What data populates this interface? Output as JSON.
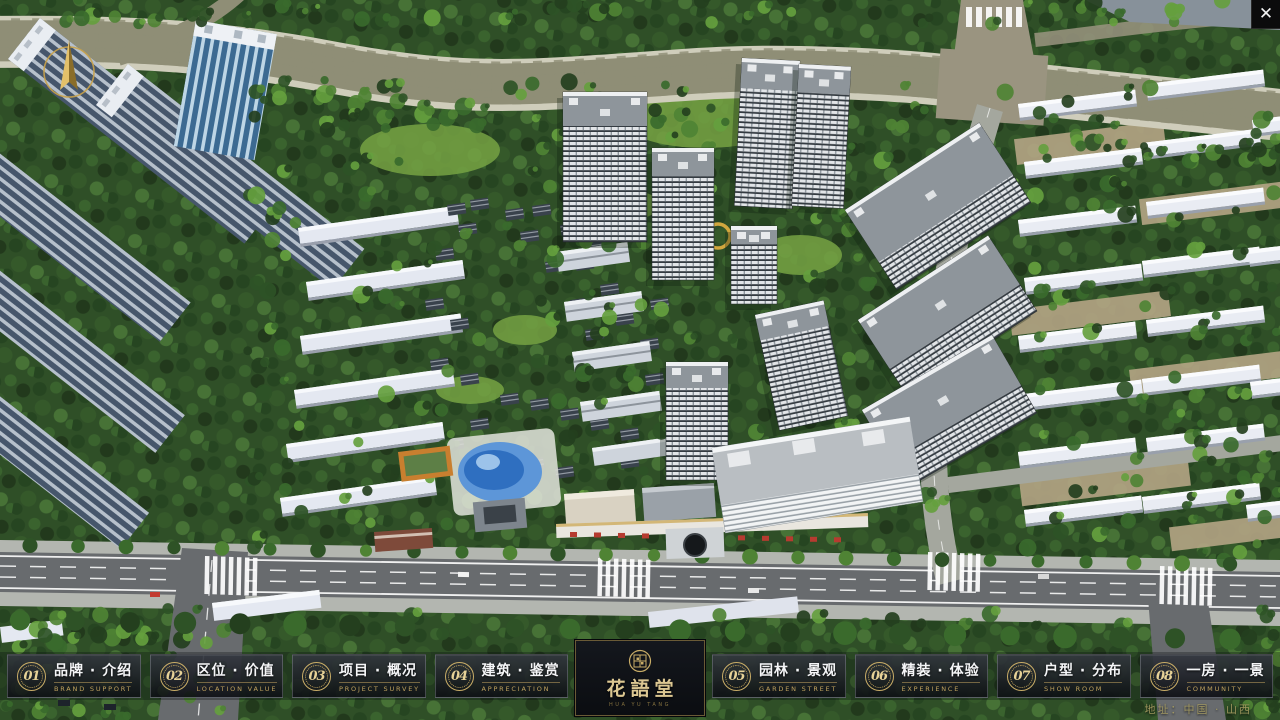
{
  "window": {
    "close_icon": "✕"
  },
  "project": {
    "name_zh": "花語堂",
    "name_en": "HUA YU TANG"
  },
  "nav": {
    "items": [
      {
        "number": "01",
        "label_zh": "品牌 · 介绍",
        "label_en": "BRAND SUPPORT"
      },
      {
        "number": "02",
        "label_zh": "区位 · 价值",
        "label_en": "LOCATION VALUE"
      },
      {
        "number": "03",
        "label_zh": "项目 · 概况",
        "label_en": "PROJECT SURVEY"
      },
      {
        "number": "04",
        "label_zh": "建筑 · 鉴赏",
        "label_en": "APPRECIATION"
      },
      {
        "number": "05",
        "label_zh": "园林 · 景观",
        "label_en": "GARDEN STREET"
      },
      {
        "number": "06",
        "label_zh": "精装 · 体验",
        "label_en": "EXPERIENCE"
      },
      {
        "number": "07",
        "label_zh": "户型 · 分布",
        "label_en": "SHOW ROOM"
      },
      {
        "number": "08",
        "label_zh": "一房 · 一景",
        "label_en": "COMMUNITY"
      }
    ]
  },
  "footer": {
    "address_label": "地址：中国 · 山西"
  },
  "colors": {
    "gold": "#c9ad67",
    "river": "#2f62c4",
    "forest": "#2f4f27"
  }
}
